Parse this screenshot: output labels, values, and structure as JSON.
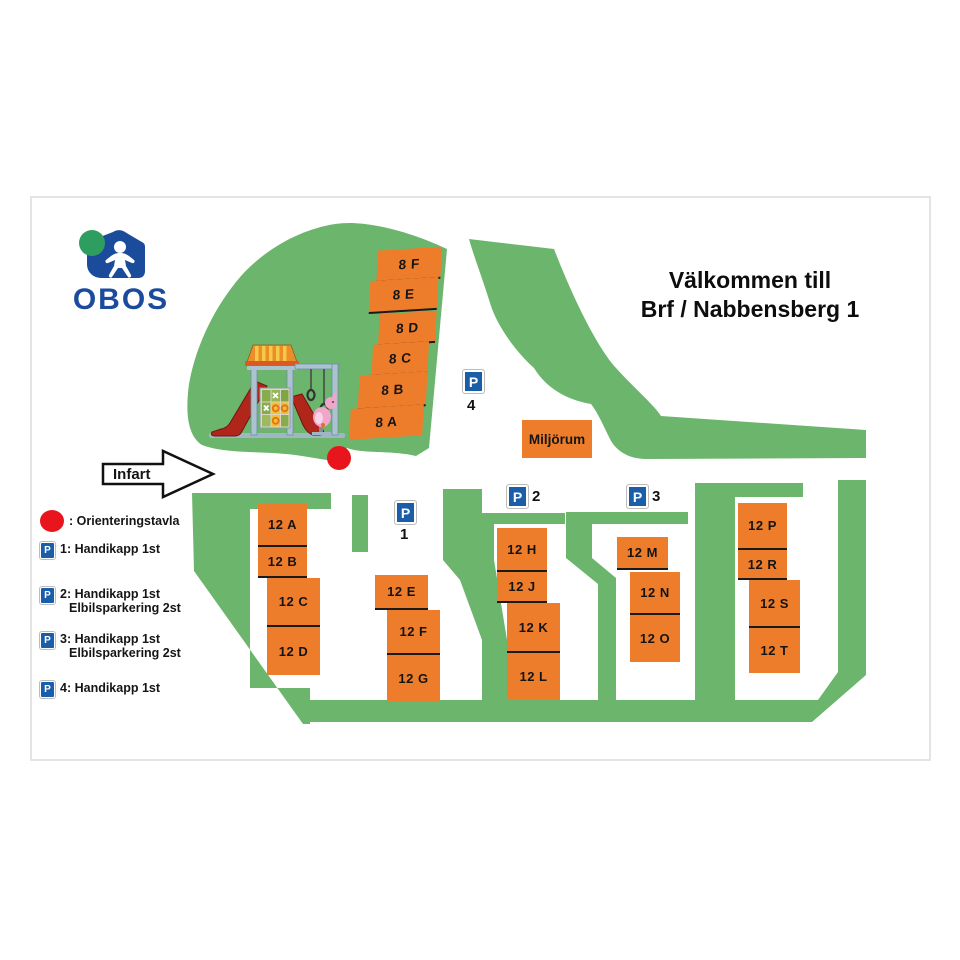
{
  "brand": {
    "wordmark": "OBOS"
  },
  "title": {
    "line1": "Välkommen till",
    "line2": "Brf / Nabbensberg 1"
  },
  "map": {
    "entrance_label": "Infart",
    "miljorum_label": "Miljörum",
    "sign_letter": "P",
    "buildings_8": [
      {
        "label": "8 F"
      },
      {
        "label": "8 E"
      },
      {
        "label": "8 D"
      },
      {
        "label": "8 C"
      },
      {
        "label": "8 B"
      },
      {
        "label": "8 A"
      }
    ],
    "col_a": [
      {
        "label": "12 A"
      },
      {
        "label": "12 B"
      },
      {
        "label": "12 C"
      },
      {
        "label": "12 D"
      }
    ],
    "col_b": [
      {
        "label": "12 E"
      },
      {
        "label": "12 F"
      },
      {
        "label": "12 G"
      }
    ],
    "col_c": [
      {
        "label": "12 H"
      },
      {
        "label": "12 J"
      },
      {
        "label": "12 K"
      },
      {
        "label": "12 L"
      }
    ],
    "col_d": [
      {
        "label": "12 M"
      },
      {
        "label": "12 N"
      },
      {
        "label": "12 O"
      }
    ],
    "col_e": [
      {
        "label": "12 P"
      },
      {
        "label": "12 R"
      },
      {
        "label": "12 S"
      },
      {
        "label": "12 T"
      }
    ],
    "parking": {
      "p1": "1",
      "p2": "2",
      "p3": "3",
      "p4": "4"
    }
  },
  "legend": {
    "marker_label": ": Orienteringstavla",
    "items": [
      {
        "sign": "P",
        "lines": [
          "1: Handikapp 1st",
          ""
        ]
      },
      {
        "sign": "P",
        "lines": [
          "2: Handikapp 1st",
          "Elbilsparkering 2st"
        ]
      },
      {
        "sign": "P",
        "lines": [
          "3: Handikapp 1st",
          "Elbilsparkering 2st"
        ]
      },
      {
        "sign": "P",
        "lines": [
          "4: Handikapp 1st",
          ""
        ]
      }
    ]
  },
  "colors": {
    "map_green": "#6CB56C",
    "building_orange": "#EE7D2B",
    "parking_blue": "#1A5DA8",
    "obos_blue": "#1A4C9B",
    "obos_green": "#2E9E60",
    "marker_red": "#E8151D"
  }
}
